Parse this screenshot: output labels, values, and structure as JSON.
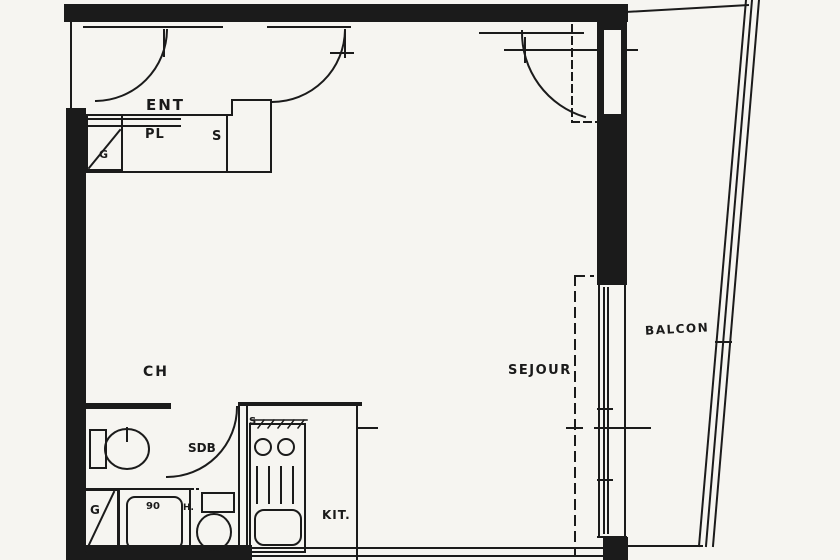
{
  "document": {
    "kind": "scanned apartment floor plan"
  },
  "colors": {
    "paper": "#f6f5f1",
    "ink": "#1b1b1b"
  },
  "labels": {
    "entry": "ENT",
    "closet": "PL",
    "closet_cupboard": "S",
    "duct_upper": "G",
    "bedroom": "CH",
    "bathroom": "SDB",
    "shower": "90",
    "water_heater": "H.",
    "duct_lower": "G",
    "kitchen": "KIT.",
    "kitchen_mark": "S",
    "living_room": "SEJOUR",
    "balcony": "BALCON"
  }
}
